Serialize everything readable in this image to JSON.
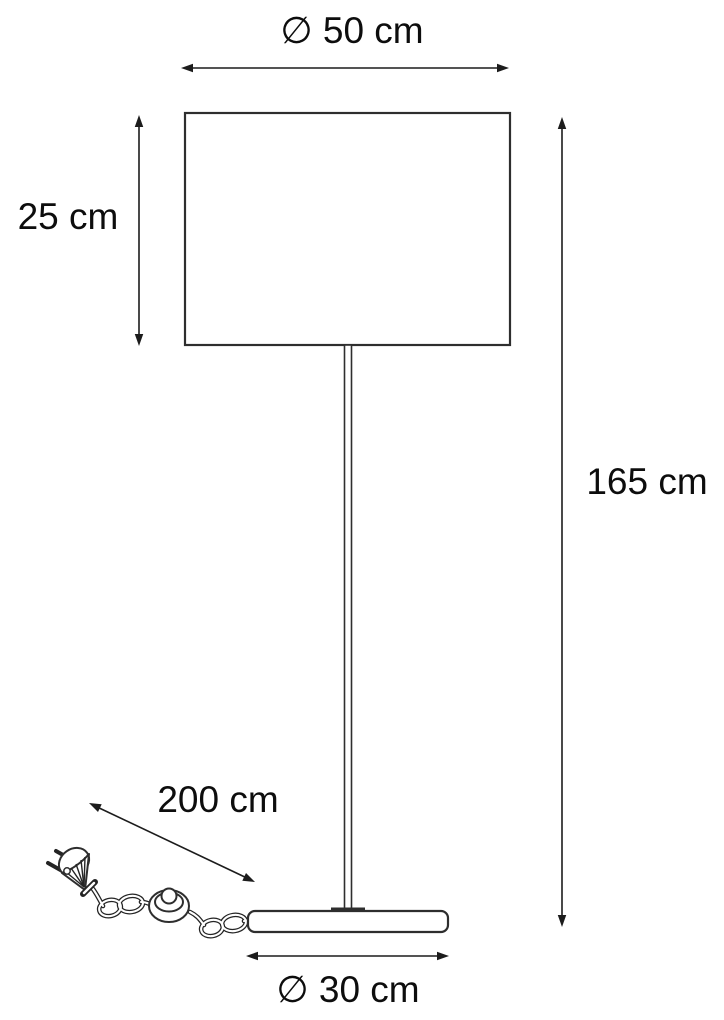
{
  "diagram": {
    "labels": {
      "shade_diameter": "∅ 50 cm",
      "shade_height": "25 cm",
      "total_height": "165 cm",
      "cord_length": "200 cm",
      "base_diameter": "∅ 30 cm"
    },
    "colors": {
      "line": "#1c1c1c",
      "outline": "#2e2e2e",
      "background": "#ffffff"
    }
  }
}
